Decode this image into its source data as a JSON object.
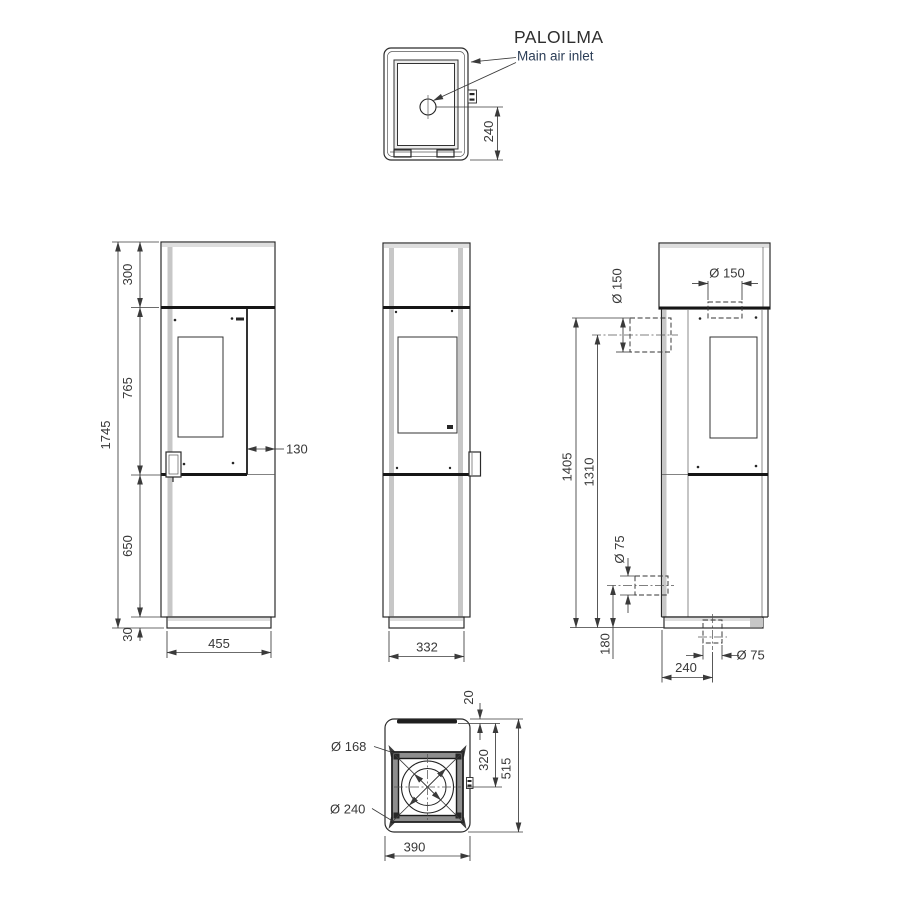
{
  "label": {
    "title": "PALOILMA",
    "subtitle": "Main air inlet"
  },
  "top": {
    "inlet_offset": "240"
  },
  "front": {
    "total": "1745",
    "top": "300",
    "door": "765",
    "lower": "650",
    "base": "30",
    "width": "455",
    "offset": "130"
  },
  "side": {
    "width": "332"
  },
  "back": {
    "flue_top": "Ø 150",
    "flue_rear": "Ø 150",
    "h_top": "1405",
    "h_center": "1310",
    "rear_inlet": "Ø 75",
    "rear_inlet_h": "180",
    "bottom_inlet": "Ø 75",
    "bottom_offset": "240"
  },
  "bottom": {
    "edge": "20",
    "center": "320",
    "depth": "515",
    "width": "390",
    "d_inner": "Ø 168",
    "d_outer": "Ø 240"
  },
  "colors": {
    "line": "#2b2b2b",
    "dim": "#3a3a3a",
    "shade": "#c7c7c7",
    "subtitle": "#2c3e57"
  }
}
